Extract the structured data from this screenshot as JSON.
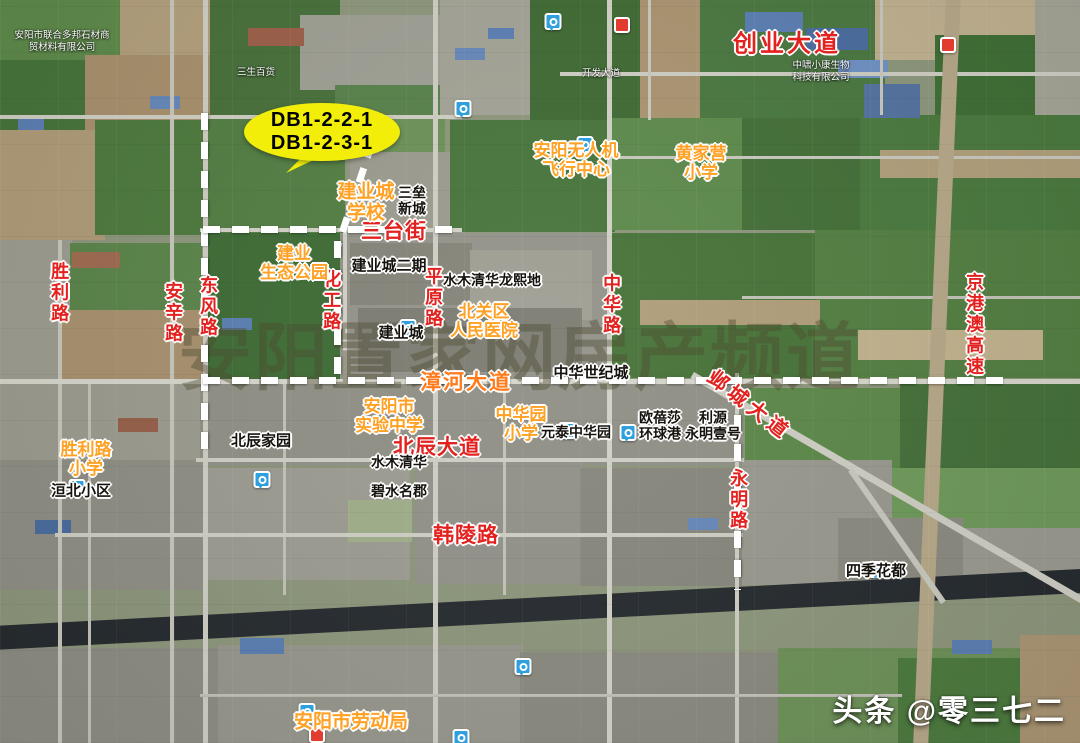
{
  "callout": {
    "line1": "DB1-2-2-1",
    "line2": "DB1-2-3-1"
  },
  "watermark": "安阳置家网房产频道",
  "branding": "头条 @零三七二",
  "roads": {
    "chuangye_dadao": "创业大道",
    "santai_jie": "三台街",
    "zhanghe_dadao": "漳河大道",
    "beichen_dadao": "北辰大道",
    "hanling_lu": "韩陵路",
    "yecheng_dadao": "邺城大道",
    "shengli_lu": "胜利路",
    "anxin_lu": "安辛路",
    "dongfeng_lu": "东风路",
    "huagong_lu": "化工路",
    "pingyuan_lu": "平原路",
    "zhonghua_lu": "中华路",
    "yongming_lu": "永明路",
    "jinggangao_gaosu": "京港澳高速"
  },
  "pois": {
    "uav_center": "安阳无人机\n飞行中心",
    "huangjiaying_primary": "黄家营\n小学",
    "jianyecheng_school": "建业城\n学校",
    "jianye_eco_park": "建业\n生态公园",
    "beiguan_hospital": "北关区\n人民医院",
    "anyang_shiyan_middle": "安阳市\n实验中学",
    "zhonghuayuan_primary": "中华园\n小学",
    "shengli_primary": "胜利路\n小学",
    "anyang_labor_bureau": "安阳市劳动局"
  },
  "places": {
    "sanlei_xincheng": "三垒\n新城",
    "jianyecheng_phase2": "建业城二期",
    "shuimu_qinghua_longxi": "水木清华龙熙地",
    "jianyecheng": "建业城",
    "zhonghua_century_city": "中华世纪城",
    "beichen_jiayuan": "北辰家园",
    "yuantai_zhonghuayuan": "元泰中华园",
    "oubeisha_global_port": "欧蓓莎\n环球港",
    "liyuan_yongming": "利源\n永明壹号",
    "shuimu_qinghua": "水木清华",
    "bishui_mingjun": "碧水名郡",
    "huanbei_xiaoqu": "洹北小区",
    "siji_huadu": "四季花都"
  },
  "small_pois": {
    "stone_company": "安阳市联合多邦石材商\n贸材料有限公司",
    "zhongxiao_biotech": "中啸小康生物\n科技有限公司",
    "sansheng_store": "三生百货",
    "kaifa_dadao": "开发大道"
  },
  "colors": {
    "road_red": "#e3221f",
    "poi_orange": "#ffa125",
    "road_orange": "#ff7b1c",
    "callout_yellow": "#f2ee0a",
    "dash_white": "#ffffff",
    "pin_blue": "#2f9fdd"
  }
}
